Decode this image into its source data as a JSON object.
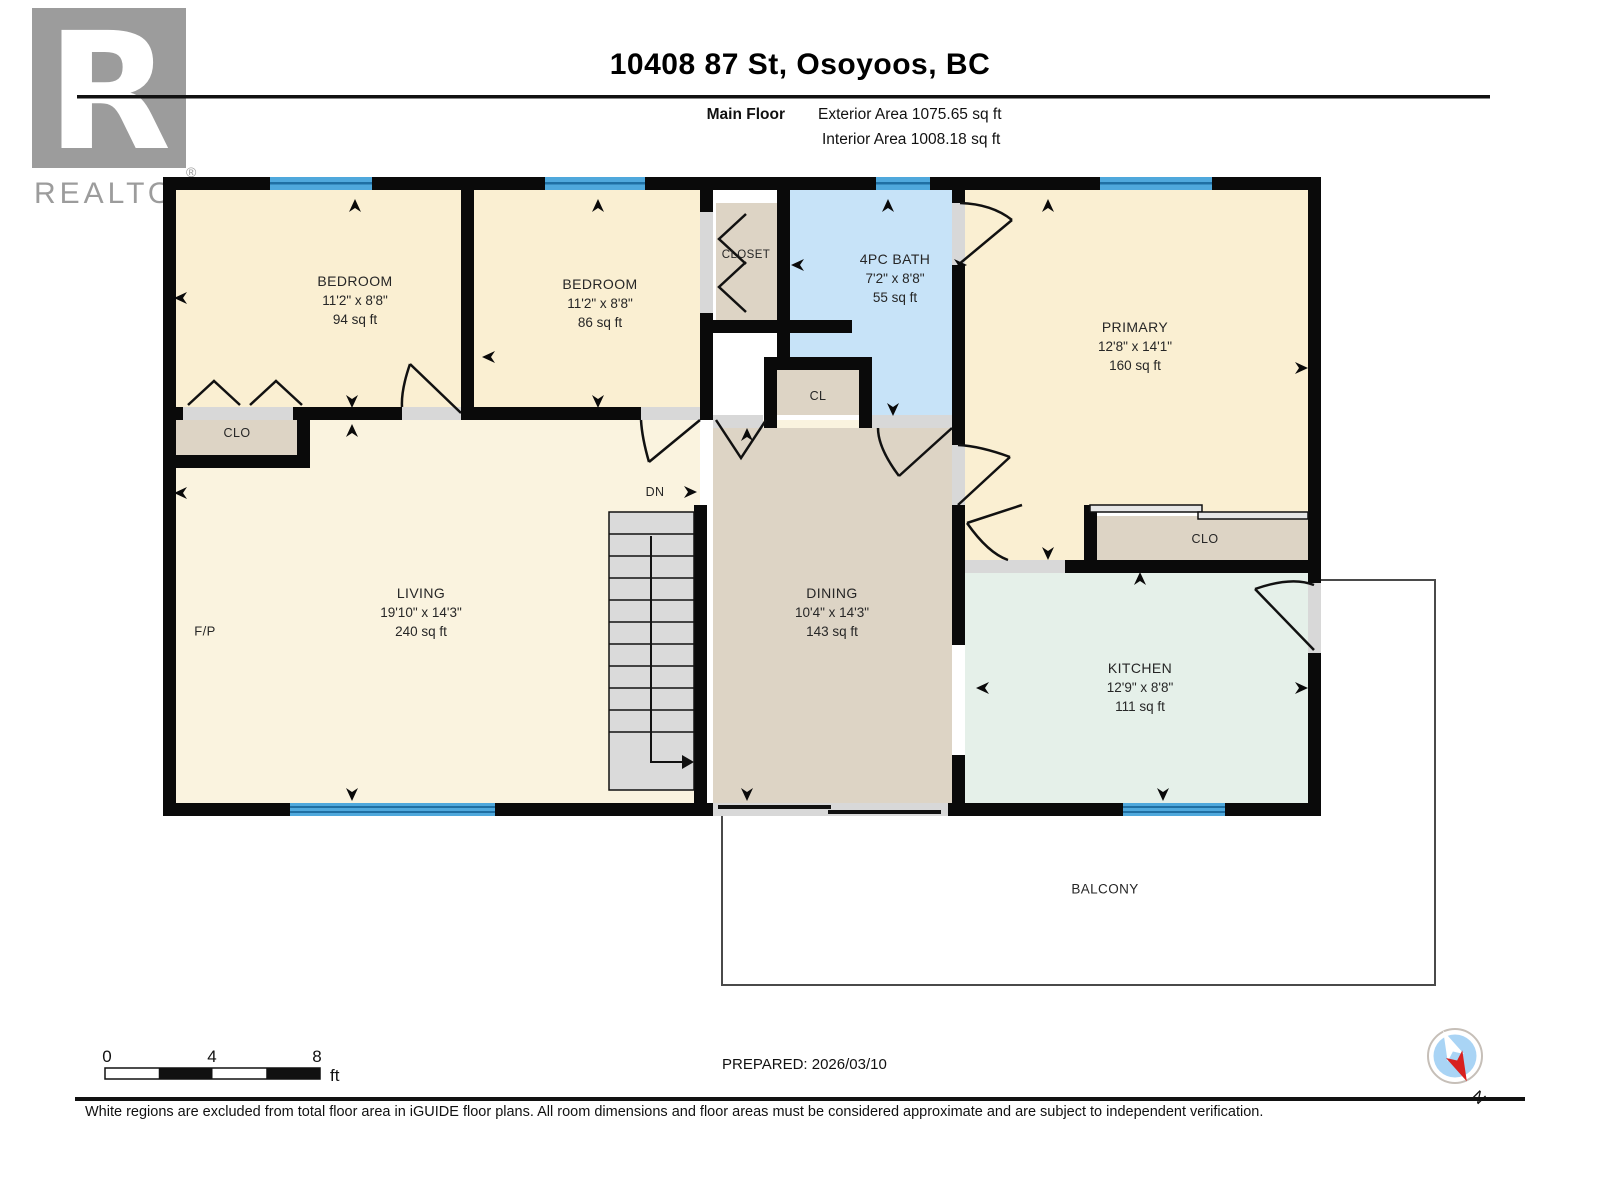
{
  "header": {
    "title": "10408 87 St, Osoyoos, BC",
    "floor_label": "Main Floor",
    "exterior_area": "Exterior Area 1075.65 sq ft",
    "interior_area": "Interior Area 1008.18 sq ft"
  },
  "watermark": {
    "letter": "R",
    "label": "REALTOR",
    "registered": "®"
  },
  "rooms": [
    {
      "id": "bedroom-1",
      "name": "BEDROOM",
      "dims": "11'2\" x 8'8\"",
      "area": "94 sq ft"
    },
    {
      "id": "bedroom-2",
      "name": "BEDROOM",
      "dims": "11'2\" x 8'8\"",
      "area": "86 sq ft"
    },
    {
      "id": "bath",
      "name": "4PC BATH",
      "dims": "7'2\" x 8'8\"",
      "area": "55 sq ft"
    },
    {
      "id": "primary",
      "name": "PRIMARY",
      "dims": "12'8\" x 14'1\"",
      "area": "160 sq ft"
    },
    {
      "id": "living",
      "name": "LIVING",
      "dims": "19'10\" x 14'3\"",
      "area": "240 sq ft"
    },
    {
      "id": "dining",
      "name": "DINING",
      "dims": "10'4\" x 14'3\"",
      "area": "143 sq ft"
    },
    {
      "id": "kitchen",
      "name": "KITCHEN",
      "dims": "12'9\" x 8'8\"",
      "area": "111 sq ft"
    }
  ],
  "small_labels": [
    {
      "id": "closet-top",
      "text": "CLOSET"
    },
    {
      "id": "clo-left",
      "text": "CLO"
    },
    {
      "id": "cl",
      "text": "CL"
    },
    {
      "id": "clo-right",
      "text": "CLO"
    },
    {
      "id": "dn",
      "text": "DN"
    },
    {
      "id": "fireplace",
      "text": "F/P"
    },
    {
      "id": "balcony",
      "text": "BALCONY"
    }
  ],
  "scale_bar": {
    "ticks": [
      "0",
      "4",
      "8"
    ],
    "unit": "ft"
  },
  "prepared": "PREPARED: 2026/03/10",
  "compass": {
    "label": "N"
  },
  "disclaimer": "White regions are excluded from total floor area in iGUIDE floor plans. All room dimensions and floor areas must be considered approximate and are subject to independent verification.",
  "colors": {
    "wall": "#0A0A0A",
    "cream": "#FAEFD2",
    "cream_light": "#FAF3DF",
    "tan": "#DDD4C5",
    "bath_blue": "#C7E3F8",
    "kitchen_mint": "#E5F0E9",
    "window_blue": "#4FA8DC",
    "window_stripe": "#1F6FA3",
    "opening_gray": "#D8D8D8",
    "stair_gray": "#DADADA",
    "door_line": "#111111",
    "balcony_line": "#4A4A4A",
    "compass_fill": "#A9D4F5",
    "compass_red": "#D8201F",
    "logo_gray": "#9C9C9C"
  }
}
